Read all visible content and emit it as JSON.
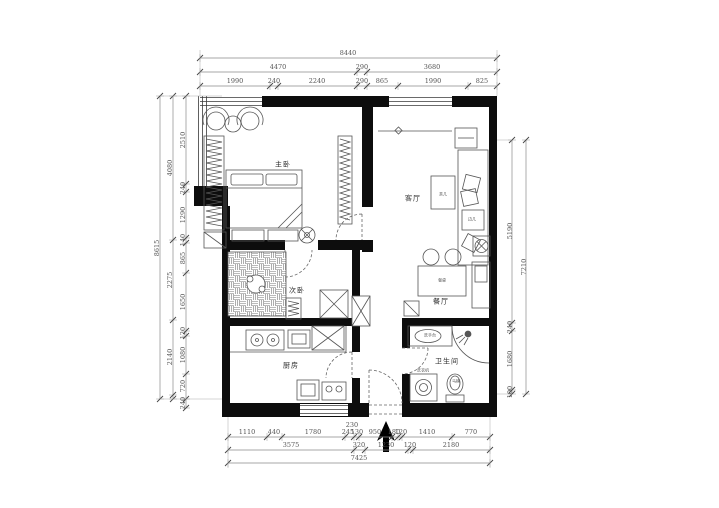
{
  "drawing": {
    "type": "apartment-floor-plan",
    "wall_color": "#0d0d0d",
    "line_color": "#555555",
    "dim_color": "#666666"
  },
  "room_labels": [
    {
      "id": "master-bedroom",
      "text": "主卧",
      "x": 283,
      "y": 165
    },
    {
      "id": "living-room",
      "text": "客厅",
      "x": 413,
      "y": 199
    },
    {
      "id": "dining-room",
      "text": "餐厅",
      "x": 441,
      "y": 302
    },
    {
      "id": "second-bedroom",
      "text": "次卧",
      "x": 297,
      "y": 291
    },
    {
      "id": "kitchen",
      "text": "厨房",
      "x": 291,
      "y": 366
    },
    {
      "id": "bathroom",
      "text": "卫生间",
      "x": 447,
      "y": 362
    }
  ],
  "furniture_labels": [
    {
      "id": "coffee-table",
      "text": "茶几",
      "x": 443,
      "y": 195
    },
    {
      "id": "dining-table",
      "text": "餐桌",
      "x": 442,
      "y": 281
    },
    {
      "id": "side-table",
      "text": "边几",
      "x": 472,
      "y": 220
    },
    {
      "id": "wash-basin",
      "text": "洗手台",
      "x": 430,
      "y": 336
    },
    {
      "id": "toilet",
      "text": "马桶",
      "x": 456,
      "y": 382
    },
    {
      "id": "washing-machine",
      "text": "洗衣机",
      "x": 423,
      "y": 371
    }
  ],
  "dim_labels": [
    {
      "text": "8440",
      "x": 348,
      "y": 53,
      "rot": 0
    },
    {
      "text": "4470",
      "x": 278,
      "y": 67,
      "rot": 0
    },
    {
      "text": "290",
      "x": 362,
      "y": 67,
      "rot": 0
    },
    {
      "text": "3680",
      "x": 432,
      "y": 67,
      "rot": 0
    },
    {
      "text": "1990",
      "x": 235,
      "y": 81,
      "rot": 0
    },
    {
      "text": "240",
      "x": 274,
      "y": 81,
      "rot": 0
    },
    {
      "text": "2240",
      "x": 317,
      "y": 81,
      "rot": 0
    },
    {
      "text": "290",
      "x": 362,
      "y": 81,
      "rot": 0
    },
    {
      "text": "865",
      "x": 382,
      "y": 81,
      "rot": 0
    },
    {
      "text": "1990",
      "x": 433,
      "y": 81,
      "rot": 0
    },
    {
      "text": "825",
      "x": 482,
      "y": 81,
      "rot": 0
    },
    {
      "text": "230",
      "x": 352,
      "y": 425,
      "rot": 0
    },
    {
      "text": "1110",
      "x": 247,
      "y": 432,
      "rot": 0
    },
    {
      "text": "440",
      "x": 274,
      "y": 432,
      "rot": 0
    },
    {
      "text": "1780",
      "x": 313,
      "y": 432,
      "rot": 0
    },
    {
      "text": "245",
      "x": 348,
      "y": 432,
      "rot": 0
    },
    {
      "text": "130",
      "x": 357,
      "y": 432,
      "rot": 0
    },
    {
      "text": "950",
      "x": 375,
      "y": 432,
      "rot": 0
    },
    {
      "text": "180",
      "x": 394,
      "y": 432,
      "rot": 0
    },
    {
      "text": "120",
      "x": 401,
      "y": 432,
      "rot": 0
    },
    {
      "text": "1410",
      "x": 427,
      "y": 432,
      "rot": 0
    },
    {
      "text": "770",
      "x": 471,
      "y": 432,
      "rot": 0
    },
    {
      "text": "3575",
      "x": 291,
      "y": 445,
      "rot": 0
    },
    {
      "text": "320",
      "x": 359,
      "y": 445,
      "rot": 0
    },
    {
      "text": "1230",
      "x": 386,
      "y": 445,
      "rot": 0
    },
    {
      "text": "120",
      "x": 410,
      "y": 445,
      "rot": 0
    },
    {
      "text": "2180",
      "x": 451,
      "y": 445,
      "rot": 0
    },
    {
      "text": "7425",
      "x": 359,
      "y": 458,
      "rot": 0
    },
    {
      "text": "8615",
      "x": 157,
      "y": 248,
      "rot": -90
    },
    {
      "text": "4080",
      "x": 170,
      "y": 168,
      "rot": -90
    },
    {
      "text": "2275",
      "x": 170,
      "y": 280,
      "rot": -90
    },
    {
      "text": "2140",
      "x": 170,
      "y": 357,
      "rot": -90
    },
    {
      "text": "2510",
      "x": 183,
      "y": 140,
      "rot": -90
    },
    {
      "text": "240",
      "x": 183,
      "y": 188,
      "rot": -90
    },
    {
      "text": "1290",
      "x": 183,
      "y": 215,
      "rot": -90
    },
    {
      "text": "140",
      "x": 183,
      "y": 240,
      "rot": -90
    },
    {
      "text": "865",
      "x": 183,
      "y": 258,
      "rot": -90
    },
    {
      "text": "1650",
      "x": 183,
      "y": 302,
      "rot": -90
    },
    {
      "text": "120",
      "x": 183,
      "y": 333,
      "rot": -90
    },
    {
      "text": "1080",
      "x": 183,
      "y": 355,
      "rot": -90
    },
    {
      "text": "720",
      "x": 183,
      "y": 386,
      "rot": -90
    },
    {
      "text": "240",
      "x": 183,
      "y": 403,
      "rot": -90
    },
    {
      "text": "7210",
      "x": 524,
      "y": 267,
      "rot": -90
    },
    {
      "text": "5190",
      "x": 510,
      "y": 231,
      "rot": -90
    },
    {
      "text": "240",
      "x": 510,
      "y": 327,
      "rot": -90
    },
    {
      "text": "1680",
      "x": 510,
      "y": 359,
      "rot": -90
    },
    {
      "text": "100",
      "x": 510,
      "y": 392,
      "rot": -90
    }
  ]
}
